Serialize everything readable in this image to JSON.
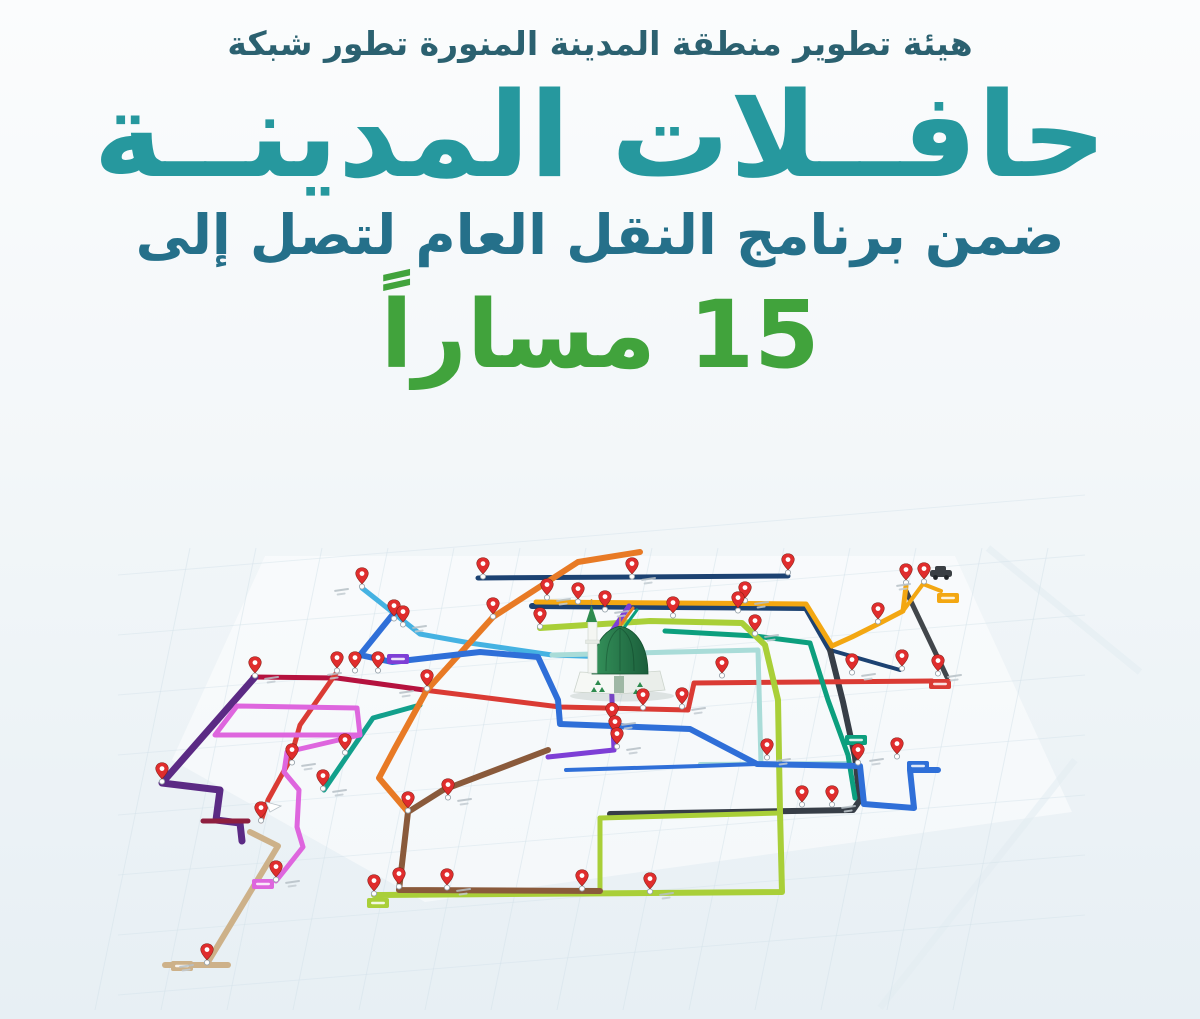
{
  "poster": {
    "tagline": "هيئة تطوير منطقة المدينة المنورة تطور شبكة",
    "title": "حافــلات المدينــة",
    "subtitle": "ضمن برنامج النقل العام لتصل إلى",
    "routes_count": "15 مساراً",
    "colors": {
      "tagline": "#2b6170",
      "title": "#26989e",
      "subtitle": "#25708a",
      "count": "#41a33c",
      "background_top": "#fbfcfd",
      "background_bottom": "#e7eff4"
    }
  },
  "map": {
    "pin_color": "#e02d2d",
    "mosque": {
      "name": "prophets-mosque",
      "dome_light": "#35935b",
      "dome_dark": "#1b5e3b"
    },
    "routes": [
      {
        "name": "navy-top",
        "color": "#1c4272",
        "width": 5,
        "points": [
          [
            478,
            578
          ],
          [
            788,
            576
          ]
        ]
      },
      {
        "name": "navy-main",
        "color": "#1c4272",
        "width": 6,
        "points": [
          [
            532,
            606
          ],
          [
            806,
            608
          ],
          [
            830,
            650
          ]
        ]
      },
      {
        "name": "navy-diagonal",
        "color": "#1c4272",
        "width": 4,
        "points": [
          [
            830,
            650
          ],
          [
            900,
            670
          ]
        ]
      },
      {
        "name": "charcoal-line",
        "color": "#373e47",
        "width": 6,
        "points": [
          [
            830,
            650
          ],
          [
            843,
            702
          ],
          [
            855,
            757
          ],
          [
            860,
            800
          ],
          [
            853,
            810
          ],
          [
            610,
            814
          ]
        ]
      },
      {
        "name": "charcoal-diagonal",
        "color": "#41464b",
        "width": 5,
        "points": [
          [
            906,
            591
          ],
          [
            947,
            677
          ]
        ]
      },
      {
        "name": "amber-line",
        "color": "#f3a712",
        "width": 5,
        "points": [
          [
            536,
            602
          ],
          [
            806,
            604
          ],
          [
            832,
            646
          ],
          [
            852,
            637
          ],
          [
            878,
            624
          ],
          [
            903,
            611
          ],
          [
            906,
            586
          ]
        ]
      },
      {
        "name": "amber-branch",
        "color": "#f3a712",
        "width": 4,
        "points": [
          [
            903,
            611
          ],
          [
            923,
            584
          ],
          [
            941,
            591
          ]
        ]
      },
      {
        "name": "crimson-line",
        "color": "#b5123e",
        "width": 5,
        "points": [
          [
            253,
            677
          ],
          [
            337,
            678
          ],
          [
            424,
            690
          ]
        ]
      },
      {
        "name": "red-line",
        "color": "#da3b34",
        "width": 5,
        "points": [
          [
            424,
            690
          ],
          [
            560,
            707
          ],
          [
            688,
            710
          ],
          [
            694,
            683
          ],
          [
            932,
            681
          ]
        ]
      },
      {
        "name": "red-south-line",
        "color": "#da3b34",
        "width": 5,
        "points": [
          [
            337,
            672
          ],
          [
            300,
            725
          ],
          [
            290,
            760
          ],
          [
            268,
            800
          ],
          [
            261,
            821
          ]
        ]
      },
      {
        "name": "sky-blue-line",
        "color": "#45b2e2",
        "width": 5,
        "points": [
          [
            362,
            588
          ],
          [
            420,
            634
          ],
          [
            470,
            643
          ],
          [
            552,
            655
          ],
          [
            610,
            657
          ]
        ]
      },
      {
        "name": "pale-teal-line",
        "color": "#a9dcd8",
        "width": 5,
        "points": [
          [
            552,
            655
          ],
          [
            758,
            650
          ],
          [
            761,
            764
          ]
        ]
      },
      {
        "name": "pale-teal-south",
        "color": "#a9dcd8",
        "width": 4,
        "points": [
          [
            700,
            764
          ],
          [
            846,
            763
          ]
        ]
      },
      {
        "name": "teal-diagonal",
        "color": "#12a08c",
        "width": 5,
        "points": [
          [
            420,
            705
          ],
          [
            373,
            718
          ],
          [
            324,
            790
          ]
        ]
      },
      {
        "name": "emerald-line",
        "color": "#0c9f7e",
        "width": 5,
        "points": [
          [
            665,
            631
          ],
          [
            755,
            636
          ],
          [
            810,
            643
          ],
          [
            828,
            700
          ],
          [
            848,
            755
          ],
          [
            855,
            798
          ]
        ]
      },
      {
        "name": "lime-line",
        "color": "#a9cf38",
        "width": 6,
        "points": [
          [
            540,
            628
          ],
          [
            650,
            621
          ],
          [
            742,
            623
          ],
          [
            765,
            645
          ],
          [
            778,
            700
          ],
          [
            780,
            812
          ],
          [
            782,
            892
          ],
          [
            374,
            895
          ]
        ]
      },
      {
        "name": "lime-loop-top",
        "color": "#a9cf38",
        "width": 5,
        "points": [
          [
            600,
            818
          ],
          [
            779,
            813
          ]
        ]
      },
      {
        "name": "lime-loop-left",
        "color": "#a9cf38",
        "width": 5,
        "points": [
          [
            600,
            818
          ],
          [
            600,
            893
          ]
        ]
      },
      {
        "name": "orange-line",
        "color": "#e87a25",
        "width": 6,
        "points": [
          [
            640,
            552
          ],
          [
            578,
            562
          ],
          [
            493,
            617
          ],
          [
            427,
            690
          ],
          [
            395,
            748
          ],
          [
            379,
            778
          ],
          [
            408,
            812
          ]
        ]
      },
      {
        "name": "violet-line",
        "color": "#7e3fd6",
        "width": 5,
        "points": [
          [
            629,
            606
          ],
          [
            610,
            634
          ],
          [
            612,
            700
          ],
          [
            614,
            750
          ],
          [
            548,
            757
          ]
        ]
      },
      {
        "name": "orange-stub",
        "color": "#e87a25",
        "width": 3,
        "points": [
          [
            633,
            608
          ],
          [
            614,
            634
          ]
        ]
      },
      {
        "name": "green-stub",
        "color": "#0c9f7e",
        "width": 3,
        "points": [
          [
            637,
            610
          ],
          [
            618,
            636
          ]
        ]
      },
      {
        "name": "brown-line",
        "color": "#8a5a3b",
        "width": 6,
        "points": [
          [
            548,
            750
          ],
          [
            443,
            790
          ],
          [
            408,
            812
          ],
          [
            399,
            890
          ],
          [
            600,
            891
          ]
        ]
      },
      {
        "name": "purple-line",
        "color": "#5b2a84",
        "width": 7,
        "points": [
          [
            255,
            677
          ],
          [
            162,
            783
          ],
          [
            220,
            790
          ],
          [
            216,
            820
          ],
          [
            240,
            823
          ],
          [
            242,
            841
          ]
        ]
      },
      {
        "name": "crimson-stub",
        "color": "#8e1f3f",
        "width": 5,
        "points": [
          [
            203,
            821
          ],
          [
            248,
            821
          ]
        ]
      },
      {
        "name": "magenta-loop",
        "color": "#de66de",
        "width": 5,
        "points": [
          [
            237,
            706
          ],
          [
            357,
            708
          ],
          [
            360,
            735
          ],
          [
            215,
            735
          ],
          [
            237,
            706
          ]
        ]
      },
      {
        "name": "magenta-tail",
        "color": "#de66de",
        "width": 5,
        "points": [
          [
            360,
            735
          ],
          [
            287,
            752
          ],
          [
            284,
            772
          ],
          [
            299,
            790
          ],
          [
            297,
            827
          ],
          [
            303,
            847
          ],
          [
            288,
            866
          ],
          [
            276,
            881
          ]
        ]
      },
      {
        "name": "tan-line",
        "color": "#cdb189",
        "width": 6,
        "points": [
          [
            250,
            832
          ],
          [
            278,
            846
          ],
          [
            208,
            962
          ]
        ]
      },
      {
        "name": "tan-stub",
        "color": "#cdb189",
        "width": 6,
        "points": [
          [
            165,
            965
          ],
          [
            228,
            965
          ]
        ]
      },
      {
        "name": "blue-line",
        "color": "#2f6fd8",
        "width": 6,
        "points": [
          [
            398,
            608
          ],
          [
            360,
            655
          ],
          [
            392,
            662
          ],
          [
            480,
            652
          ],
          [
            538,
            657
          ],
          [
            558,
            700
          ],
          [
            560,
            724
          ],
          [
            690,
            729
          ],
          [
            757,
            764
          ],
          [
            860,
            766
          ],
          [
            864,
            804
          ],
          [
            914,
            808
          ],
          [
            910,
            770
          ],
          [
            938,
            770
          ]
        ]
      },
      {
        "name": "blue-south",
        "color": "#2f6fd8",
        "width": 4,
        "points": [
          [
            566,
            770
          ],
          [
            700,
            766
          ],
          [
            757,
            764
          ]
        ]
      }
    ],
    "pins": [
      [
        362,
        586
      ],
      [
        394,
        618
      ],
      [
        403,
        624
      ],
      [
        483,
        576
      ],
      [
        632,
        576
      ],
      [
        788,
        572
      ],
      [
        852,
        672
      ],
      [
        902,
        668
      ],
      [
        938,
        673
      ],
      [
        906,
        582
      ],
      [
        924,
        581
      ],
      [
        878,
        621
      ],
      [
        745,
        600
      ],
      [
        738,
        610
      ],
      [
        755,
        633
      ],
      [
        673,
        615
      ],
      [
        547,
        597
      ],
      [
        578,
        601
      ],
      [
        605,
        609
      ],
      [
        337,
        670
      ],
      [
        355,
        670
      ],
      [
        378,
        670
      ],
      [
        255,
        675
      ],
      [
        162,
        781
      ],
      [
        292,
        762
      ],
      [
        261,
        820
      ],
      [
        276,
        879
      ],
      [
        345,
        752
      ],
      [
        323,
        788
      ],
      [
        493,
        616
      ],
      [
        427,
        688
      ],
      [
        540,
        626
      ],
      [
        612,
        721
      ],
      [
        615,
        734
      ],
      [
        617,
        746
      ],
      [
        643,
        707
      ],
      [
        682,
        706
      ],
      [
        722,
        675
      ],
      [
        767,
        757
      ],
      [
        858,
        762
      ],
      [
        897,
        756
      ],
      [
        802,
        804
      ],
      [
        832,
        804
      ],
      [
        408,
        810
      ],
      [
        448,
        797
      ],
      [
        399,
        886
      ],
      [
        447,
        887
      ],
      [
        582,
        888
      ],
      [
        650,
        891
      ],
      [
        374,
        893
      ],
      [
        207,
        962
      ]
    ],
    "badges": [
      {
        "x": 940,
        "y": 684,
        "color": "#da3b34"
      },
      {
        "x": 918,
        "y": 766,
        "color": "#2f6fd8"
      },
      {
        "x": 856,
        "y": 740,
        "color": "#0c9f7e"
      },
      {
        "x": 378,
        "y": 903,
        "color": "#a9cf38"
      },
      {
        "x": 263,
        "y": 884,
        "color": "#de66de"
      },
      {
        "x": 182,
        "y": 966,
        "color": "#cdb189"
      },
      {
        "x": 948,
        "y": 598,
        "color": "#f3a712"
      },
      {
        "x": 398,
        "y": 659,
        "color": "#7e3fd6"
      }
    ]
  }
}
